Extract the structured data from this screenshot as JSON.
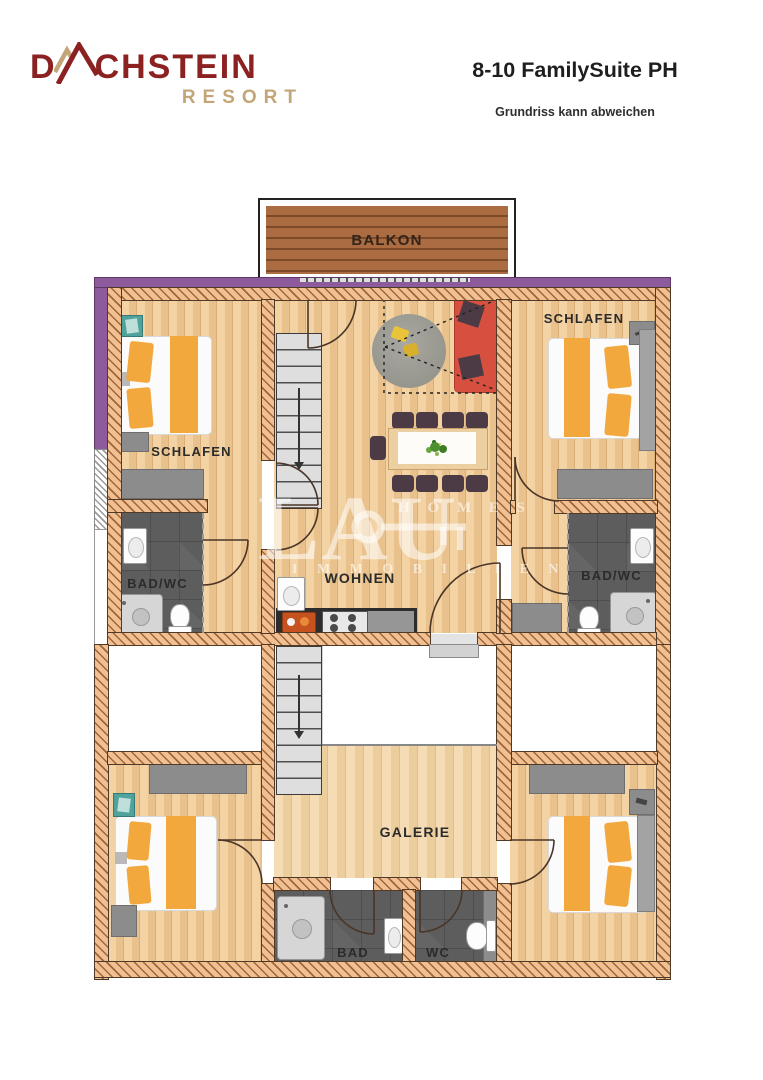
{
  "header": {
    "brand": {
      "part1": "D",
      "part2": "CHSTEIN",
      "sub": "RESORT"
    },
    "title": "8-10 FamilySuite PH",
    "subtitle": "Grundriss kann abweichen"
  },
  "rooms": {
    "balkon": "BALKON",
    "schlafen_left": "SCHLAFEN",
    "schlafen_right": "SCHLAFEN",
    "badwc_left": "BAD/WC",
    "badwc_right": "BAD/WC",
    "wohnen": "WOHNEN",
    "galerie": "GALERIE",
    "bad": "BAD",
    "wc": "WC"
  },
  "watermark": {
    "main": "LAU",
    "top": "H O M E S",
    "bottom": "I M M O B I L I E N"
  },
  "colors": {
    "brand-red": "#8c2121",
    "brand-tan": "#c2a678",
    "text-dark": "#1e1e1e",
    "wall-fill": "#f0c092",
    "wall-line": "#a06538",
    "wall-edge": "#4e3a26",
    "purple": "#8d5a9c",
    "wood-a": "#f3d2a4",
    "wood-b": "#e9c18d",
    "wood-line": "#dcae77",
    "wood-galerie-a": "#f6dcb4",
    "wood-galerie-b": "#eccd9c",
    "balcony-a": "#aa6c40",
    "balcony-b": "#7c4a26",
    "tile": "#5d5d5d",
    "fixture-gray": "#8c8c8c",
    "orange": "#f2a83d",
    "sofa-red": "#d7503f",
    "chair": "#4c3a44",
    "teal": "#50a39c",
    "stair": "#dedede",
    "label": "#2b2b2b",
    "door": "#4a3526"
  }
}
